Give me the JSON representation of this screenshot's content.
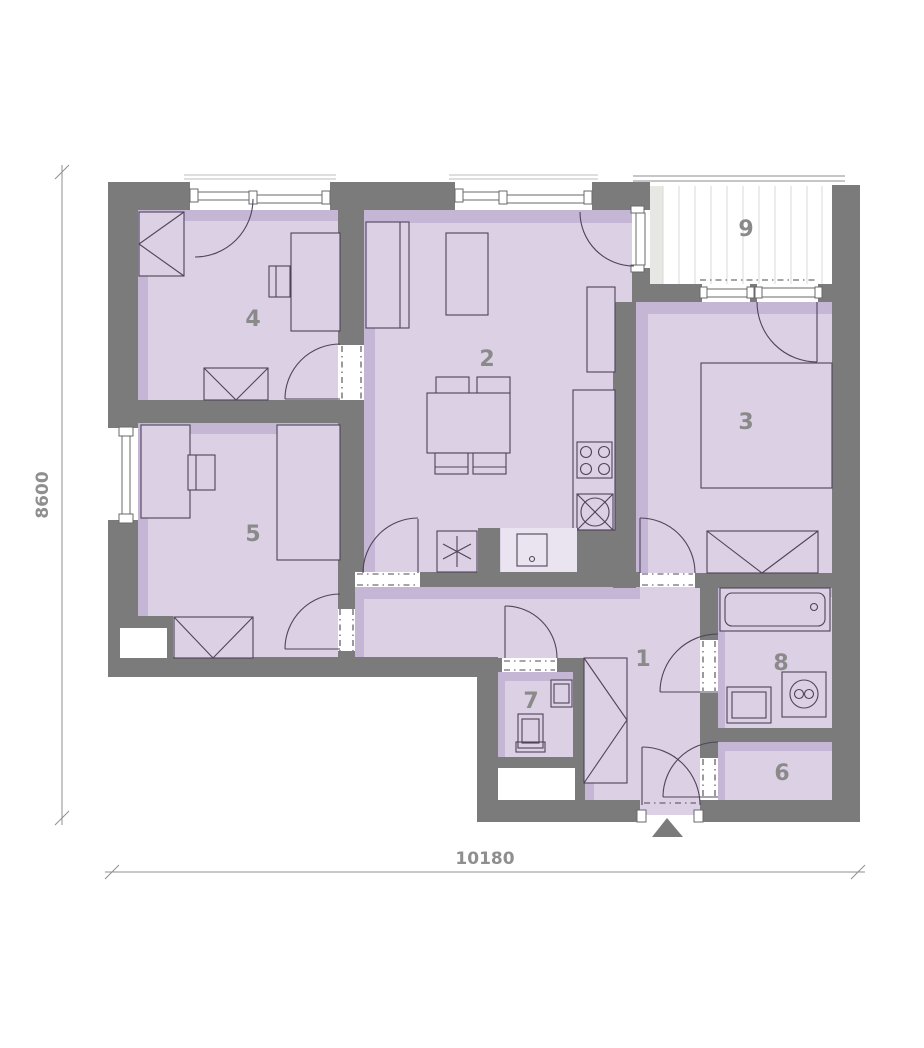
{
  "plan": {
    "title": "apartment floor plan",
    "rooms": [
      {
        "number": "1"
      },
      {
        "number": "2"
      },
      {
        "number": "3"
      },
      {
        "number": "4"
      },
      {
        "number": "5"
      },
      {
        "number": "6"
      },
      {
        "number": "7"
      },
      {
        "number": "8"
      },
      {
        "number": "9"
      }
    ],
    "dimensions": {
      "width_mm": "10180",
      "height_mm": "8600"
    },
    "colors": {
      "wall": "#7b7b7b",
      "room_fill": "#dcd0e4",
      "room_shadow": "#c6b6d6",
      "niche": "#eae4f1",
      "line": "#4f4459",
      "balcony_stripe": "#d8d8d4",
      "balcony_shade": "#e7e7e3",
      "railing": "#b3b3b3",
      "lintel": "#bdbdbd",
      "label_text": "#8a8a8a",
      "dim_text": "#8f8f8f"
    }
  }
}
